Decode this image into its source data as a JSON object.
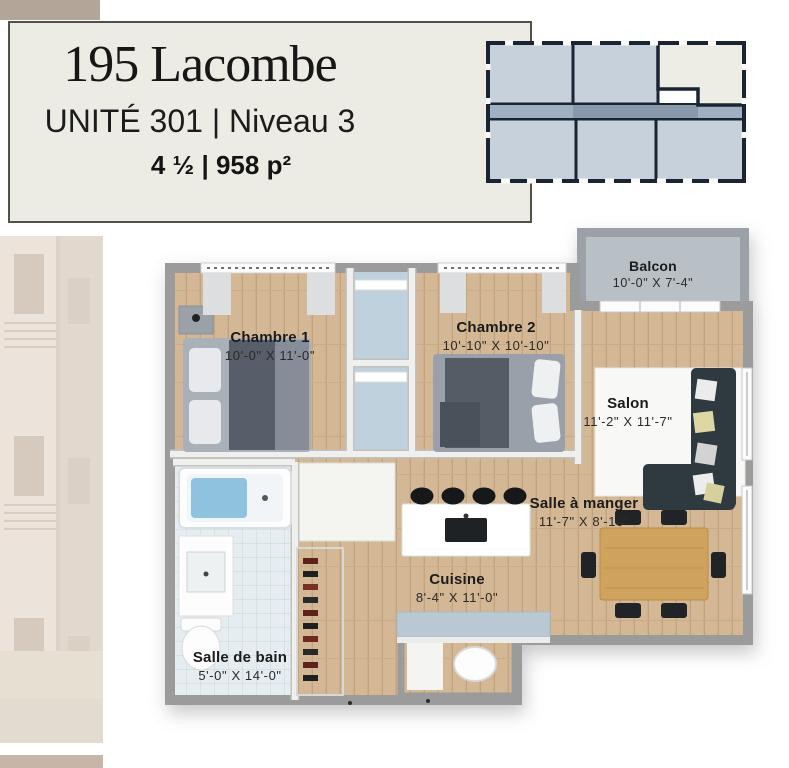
{
  "header": {
    "title": "195 Lacombe",
    "subtitle": "UNITÉ 301 | Niveau 3",
    "details": "4 ½ | 958 p²"
  },
  "floorplan": {
    "rooms": [
      {
        "id": "balcon",
        "name": "Balcon",
        "dims": "10'-0\" X 7'-4\""
      },
      {
        "id": "chambre-1",
        "name": "Chambre 1",
        "dims": "10'-0\" X 11'-0\""
      },
      {
        "id": "chambre-2",
        "name": "Chambre 2",
        "dims": "10'-10\" X 10'-10\""
      },
      {
        "id": "salon",
        "name": "Salon",
        "dims": "11'-2\" X 11'-7\""
      },
      {
        "id": "salle-a-manger",
        "name": "Salle à manger",
        "dims": "11'-7\" X 8'-10\""
      },
      {
        "id": "cuisine",
        "name": "Cuisine",
        "dims": "8'-4\" X 11'-0\""
      },
      {
        "id": "salle-de-bain",
        "name": "Salle de bain",
        "dims": "5'-0\" X 14'-0\""
      }
    ]
  },
  "colors": {
    "title_box_bg": "#edece4",
    "title_box_border": "#51504b",
    "accent_tan": "#b3a597",
    "wall_gray": "#9b9b9b",
    "wood_floor": "#d4b795",
    "bath_tile": "#e6edf1",
    "closet_blue": "#bfd1dc",
    "balcony_concrete": "#b8bfc5",
    "keyplan_navy": "#1b2433",
    "keyplan_unit_fill": "#c7d1dc",
    "keyplan_highlight": "#eeede5",
    "sofa_dark": "#2e3a40",
    "table_wood": "#cfa35e",
    "counter_blue": "#b9c8d3"
  }
}
